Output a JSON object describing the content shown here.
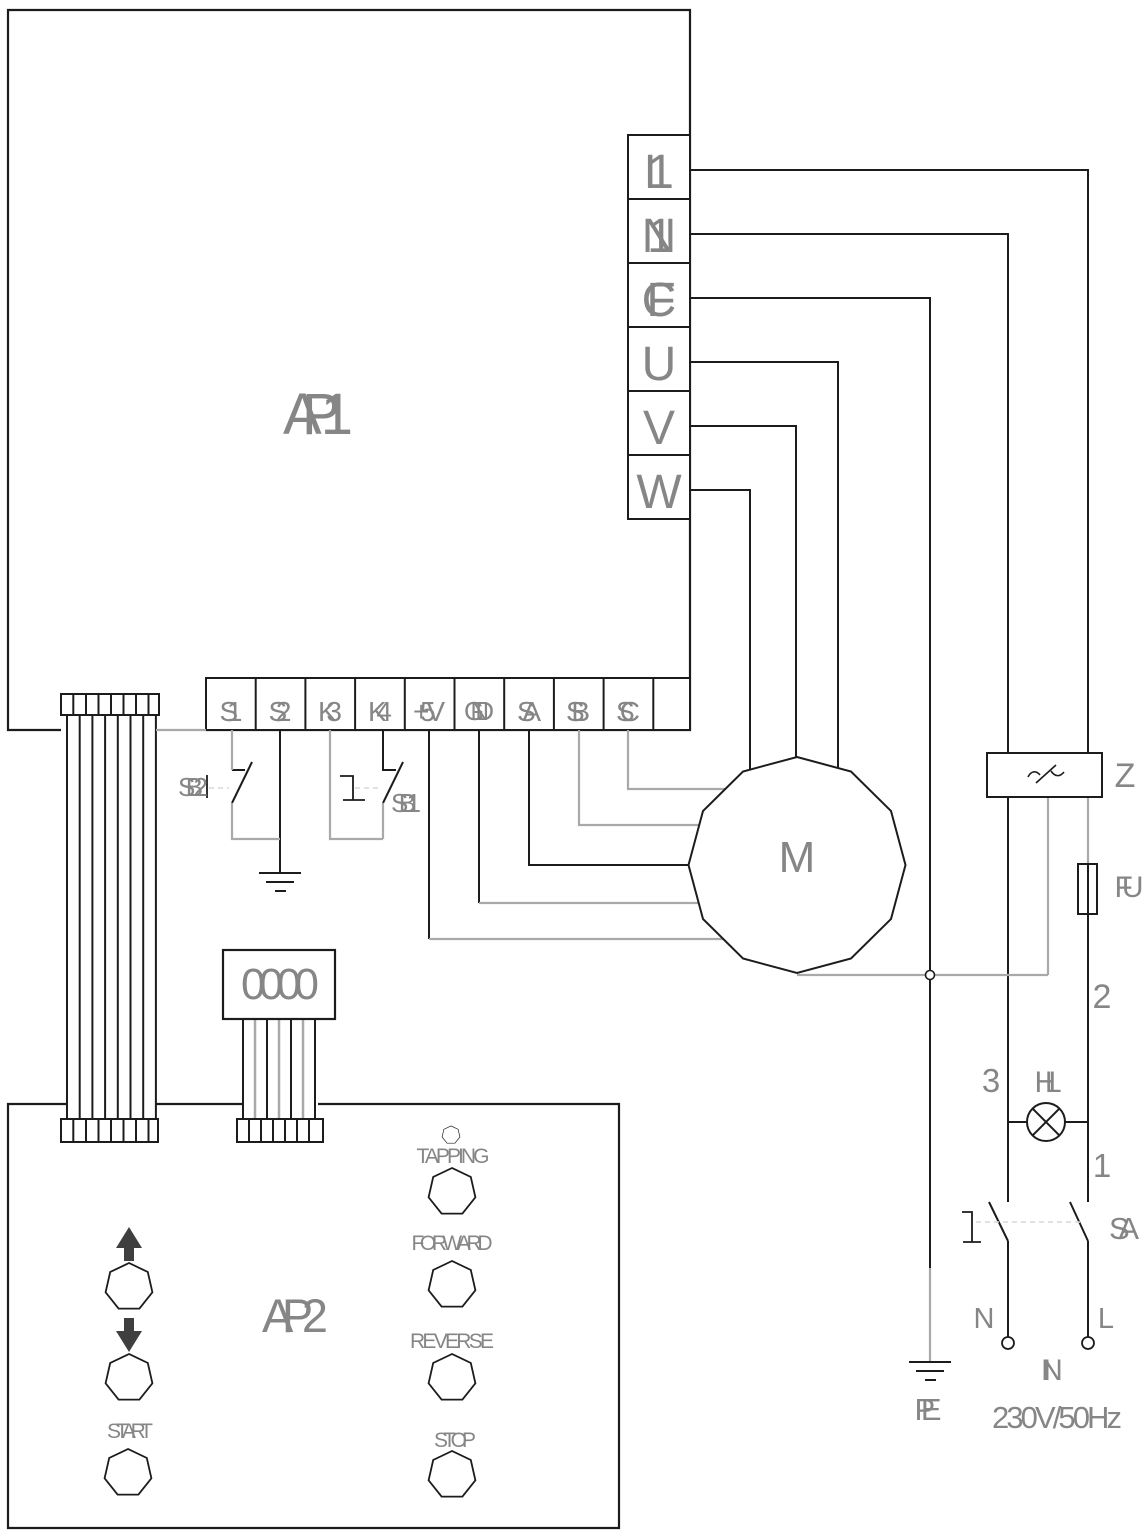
{
  "colors": {
    "wire_dark": "#1c1c1c",
    "wire_gray": "#a9a9a9",
    "label": "#868686",
    "dash": "#d9d9d9",
    "arrow": "#3f3f3f",
    "background": "#ffffff"
  },
  "ap1": {
    "label": "AP1"
  },
  "power_terminals": {
    "labels": [
      "L1",
      "N1",
      "FC",
      "U",
      "V",
      "W"
    ]
  },
  "signal_terminals": {
    "labels": [
      "S1",
      "S2",
      "K3",
      "K4",
      "+5V",
      "GND",
      "SA",
      "SB",
      "SC"
    ]
  },
  "switches": {
    "sb2": "SB2",
    "sb1": "SB1",
    "sa": "SA"
  },
  "display": {
    "value": "0000"
  },
  "motor": {
    "label": "M"
  },
  "components": {
    "filter": "Z",
    "fuse": "FU",
    "lamp": "HL"
  },
  "wire_numbers": {
    "n1": "1",
    "n2": "2",
    "n3": "3"
  },
  "power_input": {
    "neutral": "N",
    "line": "L",
    "earth": "PE",
    "input_label": "IN",
    "rating": "230V/50Hz"
  },
  "ap2": {
    "label": "AP2",
    "buttons": {
      "start": "START",
      "tapping": "TAPPING",
      "forward": "FORWARD",
      "reverse": "REVERSE",
      "stop": "STOP"
    }
  }
}
